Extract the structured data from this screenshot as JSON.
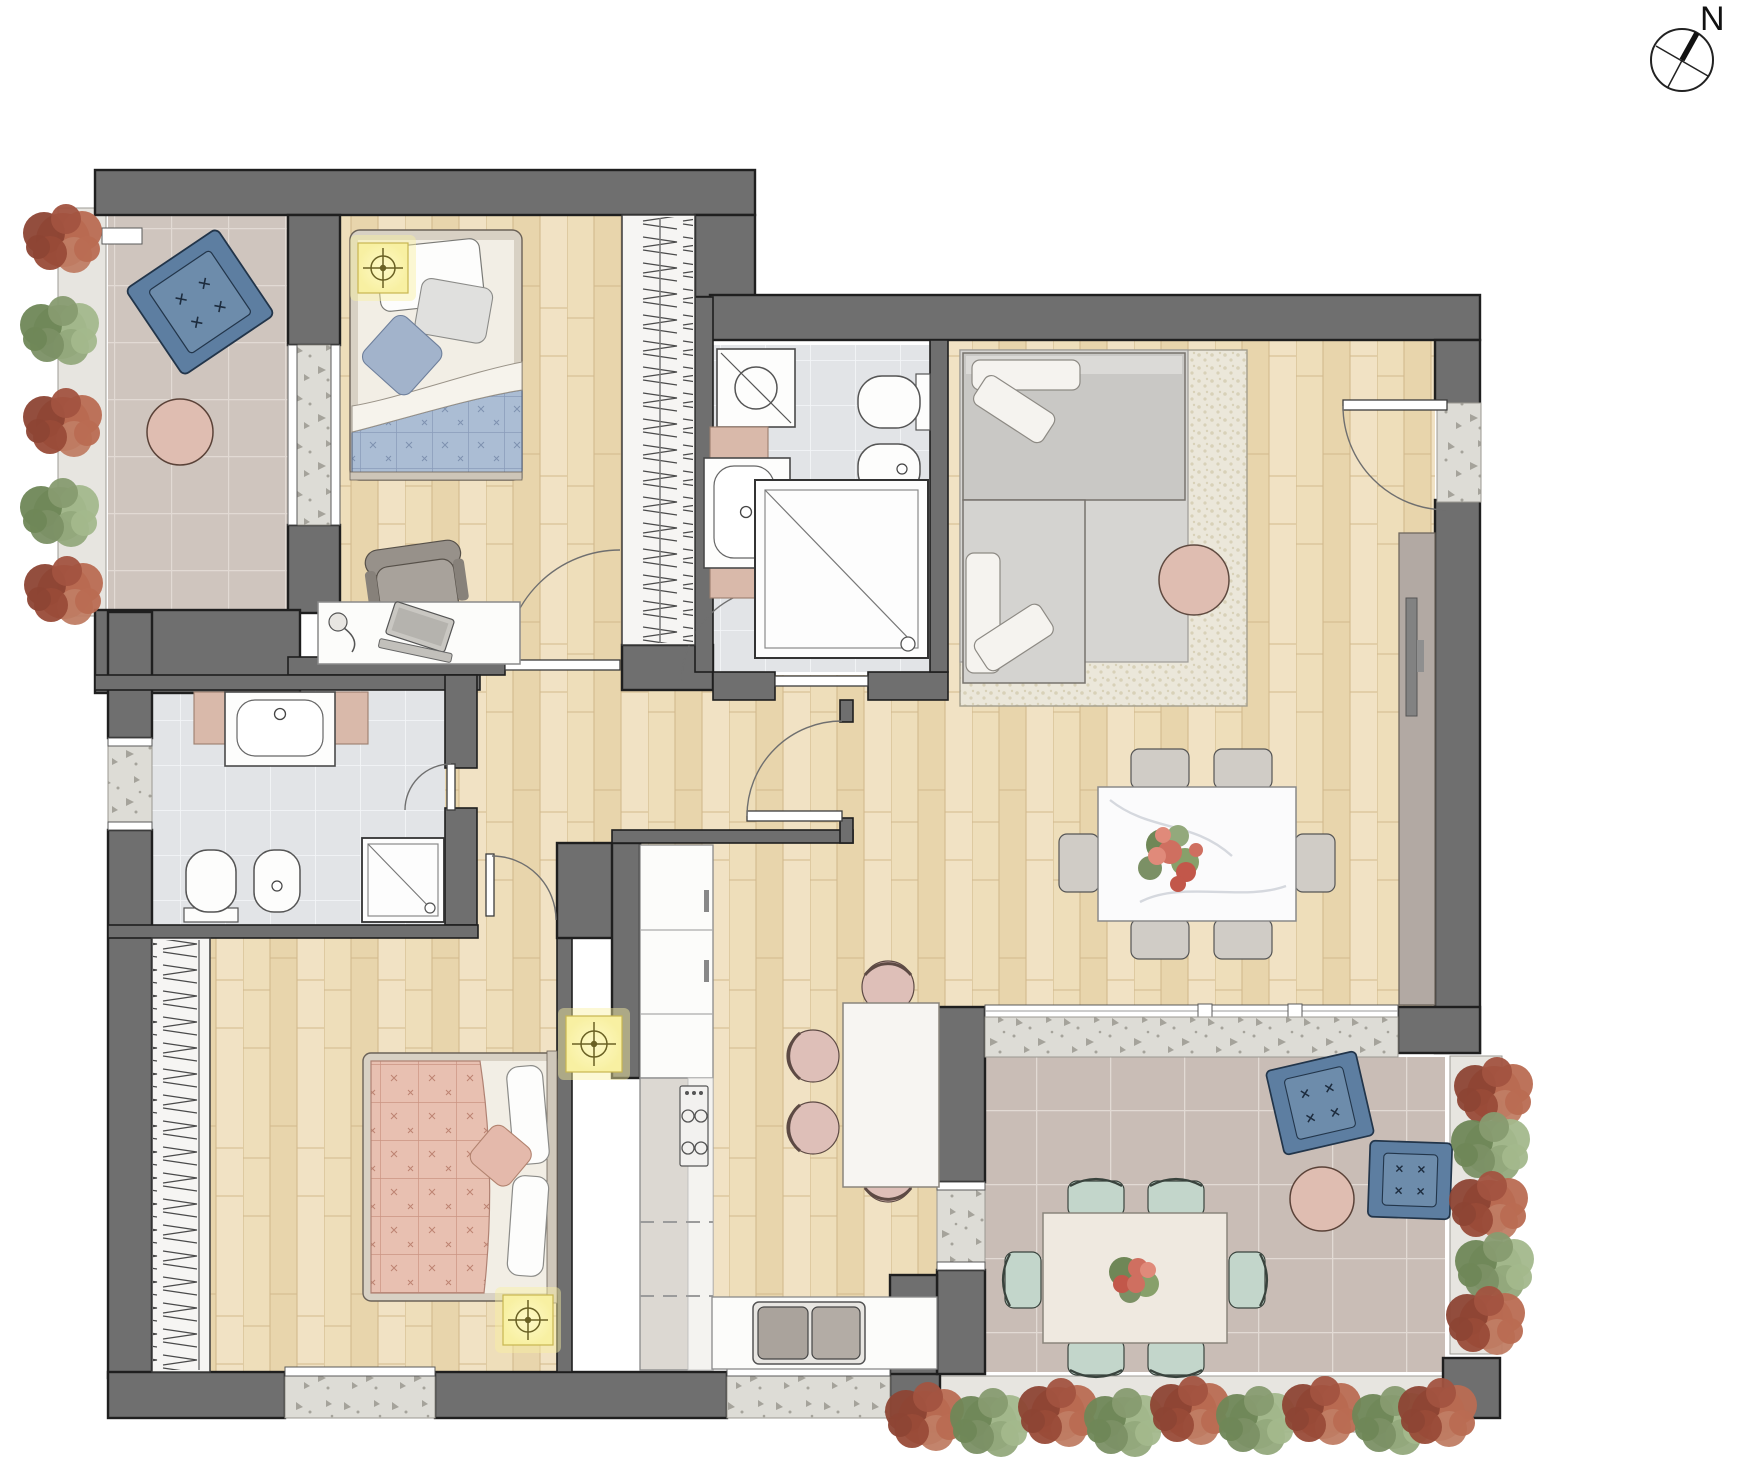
{
  "compass": {
    "label": "N"
  },
  "palette": {
    "ink": "#1f1f1f",
    "wall": "#6f6f6f",
    "doorArc": "#6f6f6f",
    "woodBase": "#eedeba",
    "woodShade": "#e8d5ac",
    "woodHi": "#f1e2c4",
    "woodLine": "#d2b98d",
    "tileBalcony": "#cfc5be",
    "tileTerrace": "#c9bdb6",
    "groutWarm": "#e2dad4",
    "tileBath": "#e2e4e7",
    "groutCool": "#f3f5f7",
    "concrete": "#dddcd6",
    "fleck": "#a5a39b",
    "accentBlue": "#5d7ea1",
    "accentBlueLight": "#6d8cab",
    "blueInk": "#22354a",
    "blushPink": "#dfbdb1",
    "blushInk": "#5a4238",
    "quiltBlue": "#abbdd4",
    "quiltBlueLine": "#8a9cba",
    "quiltPink": "#e8c0b1",
    "quiltPinkLine": "#cb9483",
    "sofaGray": "#c9c8c5",
    "sofaLight": "#d4d3d0",
    "cushion": "#f5f3ef",
    "rugBase": "#ebe7da",
    "rugDot": "#d8d1b8",
    "rugGray": "#d6d5d2",
    "lightYellow": "#f8f0a2",
    "lightInk": "#6a6124",
    "tealChair": "#c3d6cb",
    "tealInk": "#39433d",
    "grayChair": "#d0ccc6",
    "pinkChair": "#debfb8",
    "fixtureWhite": "#fdfdfc",
    "fixtureInk": "#4a4a4a",
    "counterPink": "#d9b9aa",
    "sideboard": "#b2a9a3",
    "tvGray": "#828282"
  },
  "plants": {
    "colors": {
      "red": [
        "#a25340",
        "#b96b52",
        "#8d4534",
        "#c07d64",
        "#994b38"
      ],
      "green": [
        "#879b70",
        "#a3b88c",
        "#6f8757",
        "#93a97c",
        "#7b9065"
      ]
    },
    "groups": [
      {
        "name": "balcony-left-planter",
        "items": [
          {
            "x": 63,
            "y": 240,
            "c": "red"
          },
          {
            "x": 60,
            "y": 332,
            "c": "green"
          },
          {
            "x": 63,
            "y": 424,
            "c": "red"
          },
          {
            "x": 60,
            "y": 514,
            "c": "green"
          },
          {
            "x": 64,
            "y": 592,
            "c": "red"
          }
        ]
      },
      {
        "name": "terrace-right-planter",
        "items": [
          {
            "x": 1494,
            "y": 1093,
            "c": "red"
          },
          {
            "x": 1491,
            "y": 1148,
            "c": "green"
          },
          {
            "x": 1489,
            "y": 1207,
            "c": "red"
          },
          {
            "x": 1495,
            "y": 1268,
            "c": "green"
          },
          {
            "x": 1486,
            "y": 1322,
            "c": "red"
          }
        ]
      },
      {
        "name": "terrace-bottom-planter",
        "items": [
          {
            "x": 925,
            "y": 1418,
            "c": "red"
          },
          {
            "x": 990,
            "y": 1424,
            "c": "green"
          },
          {
            "x": 1058,
            "y": 1414,
            "c": "red"
          },
          {
            "x": 1124,
            "y": 1424,
            "c": "green"
          },
          {
            "x": 1190,
            "y": 1412,
            "c": "red"
          },
          {
            "x": 1256,
            "y": 1422,
            "c": "green"
          },
          {
            "x": 1322,
            "y": 1412,
            "c": "red"
          },
          {
            "x": 1392,
            "y": 1422,
            "c": "green"
          },
          {
            "x": 1438,
            "y": 1414,
            "c": "red"
          }
        ]
      }
    ]
  }
}
